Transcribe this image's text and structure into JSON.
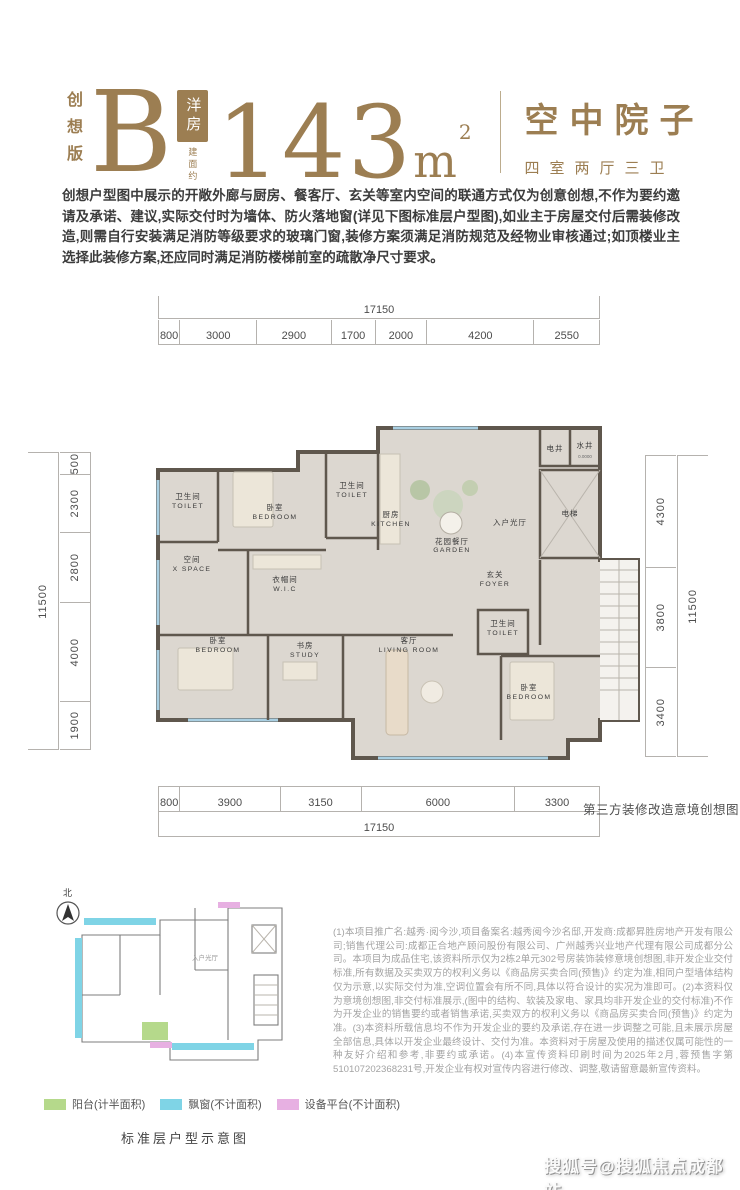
{
  "header": {
    "edition": "创想版",
    "type_letter": "B",
    "type_badge": "洋房",
    "area_prefix": "建面约",
    "area_number": "143",
    "area_unit": "m",
    "area_exponent": "2",
    "right_title": "空中院子",
    "right_subtitle": "四室两厅三卫",
    "accent_color": "#9c7e52"
  },
  "notice": "创想户型图中展示的开敞外廊与厨房、餐客厅、玄关等室内空间的联通方式仅为创意创想,不作为要约邀请及承诺、建议,实际交付时为墙体、防火落地窗(详见下图标准层户型图),如业主于房屋交付后需装修改造,则需自行安装满足消防等级要求的玻璃门窗,装修方案须满足消防规范及经物业审核通过;如顶楼业主选择此装修方案,还应同时满足消防楼梯前室的疏散净尺寸要求。",
  "plan": {
    "dims_top_total": "17150",
    "dims_top": [
      "800",
      "3000",
      "2900",
      "1700",
      "2000",
      "4200",
      "2550"
    ],
    "dims_bottom": [
      "800",
      "3900",
      "3150",
      "6000",
      "3300"
    ],
    "dims_bottom_total": "17150",
    "dims_left_total": "11500",
    "dims_left": [
      "500",
      "2300",
      "2800",
      "4000",
      "1900"
    ],
    "dims_right": [
      "4300",
      "3800",
      "3400"
    ],
    "dims_right_total": "11500",
    "caption": "第三方装修改造意境创想图",
    "rooms": {
      "toilet1": {
        "zh": "卫生间",
        "en": "TOILET"
      },
      "bedroom1": {
        "zh": "卧室",
        "en": "BEDROOM"
      },
      "toilet2": {
        "zh": "卫生间",
        "en": "TOILET"
      },
      "kitchen": {
        "zh": "厨房",
        "en": "KITCHEN"
      },
      "garden": {
        "zh": "花园餐厅",
        "en": "GARDEN"
      },
      "entry": {
        "zh": "入户光厅"
      },
      "shaft_elec": {
        "zh": "电井"
      },
      "shaft_water": {
        "zh": "水井"
      },
      "shaft_level": {
        "zh": "0.0000"
      },
      "elevator": {
        "zh": "电梯"
      },
      "xspace": {
        "zh": "空间",
        "en": "X SPACE"
      },
      "wic": {
        "zh": "衣帽间",
        "en": "W.I.C"
      },
      "foyer": {
        "zh": "玄关",
        "en": "FOYER"
      },
      "bedroom2": {
        "zh": "卧室",
        "en": "BEDROOM"
      },
      "study": {
        "zh": "书房",
        "en": "STUDY"
      },
      "living": {
        "zh": "客厅",
        "en": "LIVING ROOM"
      },
      "toilet3": {
        "zh": "卫生间",
        "en": "TOILET"
      },
      "bedroom3": {
        "zh": "卧室",
        "en": "BEDROOM"
      }
    }
  },
  "standard_plan": {
    "north_label": "北",
    "entry_label": "入户光厅",
    "legend": [
      {
        "label": "阳台(计半面积)",
        "color": "#b5d98b"
      },
      {
        "label": "飘窗(不计面积)",
        "color": "#7fd4e6"
      },
      {
        "label": "设备平台(不计面积)",
        "color": "#e7b0e2"
      }
    ],
    "caption": "标准层户型示意图"
  },
  "legal": "(1)本项目推广名:越秀·阅今沙,项目备案名:越秀阅今沙名邸,开发商:成都昇胜房地产开发有限公司;销售代理公司:成都正合地产顾问股份有限公司、广州越秀兴业地产代理有限公司成都分公司。本项目为成品住宅,该资料所示仅为2栋2单元302号房装饰装修意境创想图,非开发企业交付标准,所有数据及买卖双方的权利义务以《商品房买卖合同(预售)》约定为准,相同户型墙体结构仅为示意,以实际交付为准,空调位置会有所不同,具体以符合设计的实况为准即可。(2)本资料仅为意境创想图,非交付标准展示,(图中的结构、软装及家电、家具均非开发企业的交付标准)不作为开发企业的销售要约或者销售承诺,买卖双方的权利义务以《商品房买卖合同(预售)》约定为准。(3)本资料所载信息均不作为开发企业的要约及承诺,存在进一步调整之可能,且未展示房屋全部信息,具体以开发企业最终设计、交付为准。本资料对于房屋及使用的描述仅属可能性的一种友好介绍和参考,非要约或承诺。(4)本宣传资料印刷时间为2025年2月,蓉预售字第510107202368231号,开发企业有权对宣传内容进行修改、调整,敬请留意最新宣传资料。",
  "watermark": "搜狐号@搜狐焦点成都站"
}
